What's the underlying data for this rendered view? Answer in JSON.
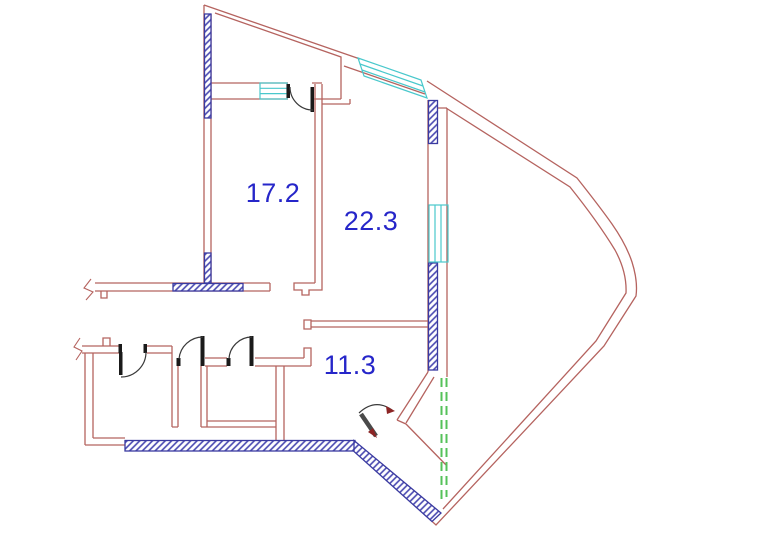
{
  "plan": {
    "type": "apartment-floor-plan",
    "rooms": [
      {
        "id": "room-a",
        "area": "17.2"
      },
      {
        "id": "room-b",
        "area": "22.3"
      },
      {
        "id": "room-c",
        "area": "11.3"
      }
    ],
    "colors": {
      "wall": "#b5635f",
      "hatch_line": "#4747b0",
      "hatch_border": "#3a3aa0",
      "window": "#49c8cc",
      "glazing": "#55c25a",
      "door": "#1a1a1a",
      "door_arc": "#3a3a3a",
      "door_leaf_entry": "#4a4a4a",
      "swing_arrow": "#8c2525",
      "label": "#2626c9",
      "background": "#ffffff"
    }
  }
}
